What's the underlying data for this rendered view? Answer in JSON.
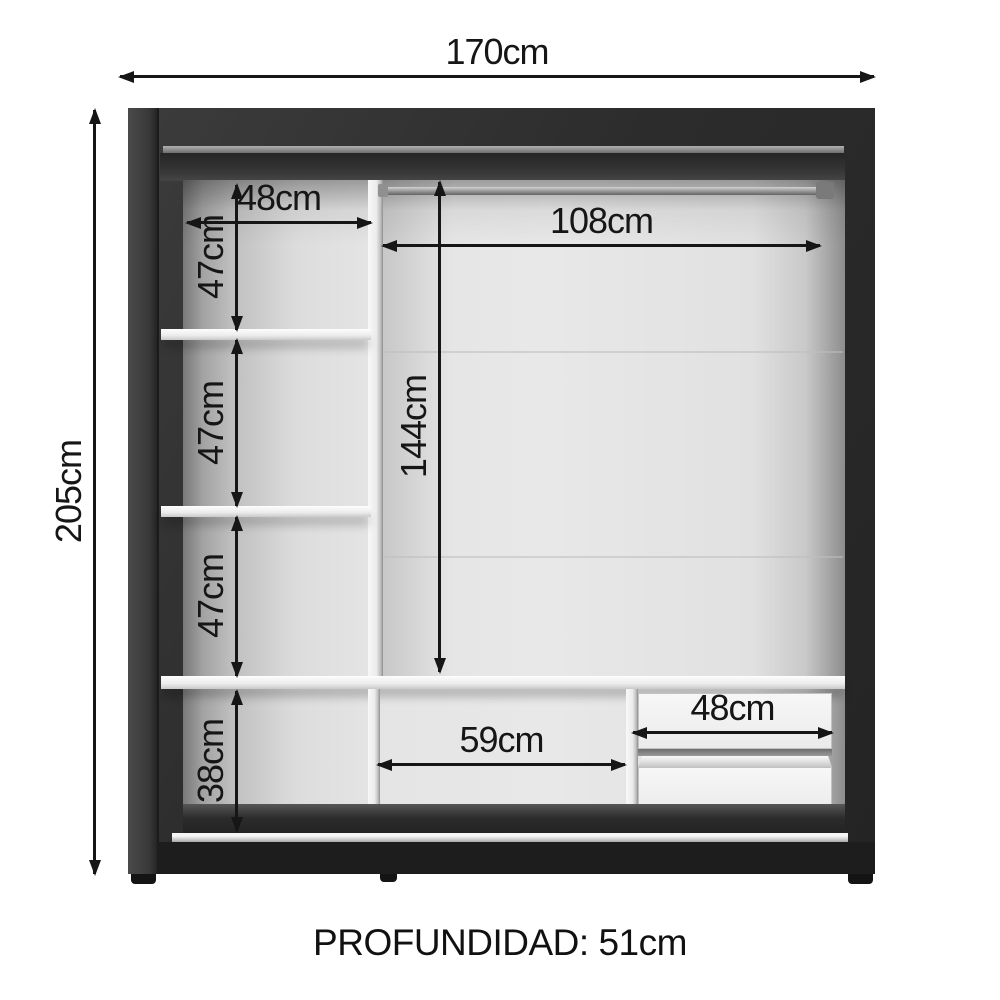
{
  "diagram": {
    "type": "wardrobe-interior-dimension-diagram",
    "dimensions": {
      "total_width": "170cm",
      "total_height": "205cm",
      "upper_shelf_width": "48cm",
      "shelf_gap_1": "47cm",
      "shelf_gap_2": "47cm",
      "shelf_gap_3": "47cm",
      "bottom_section_height": "38cm",
      "rod_section_width": "108cm",
      "hanging_height": "144cm",
      "bottom_middle_width": "59cm",
      "drawer_width": "48cm"
    },
    "footer": {
      "depth_label": "PROFUNDIDAD: 51cm"
    },
    "colors": {
      "frame": "#2d2d2d",
      "interior_panel": "#e5e5e5",
      "dimension_lines": "#161616",
      "background": "#ffffff"
    }
  }
}
